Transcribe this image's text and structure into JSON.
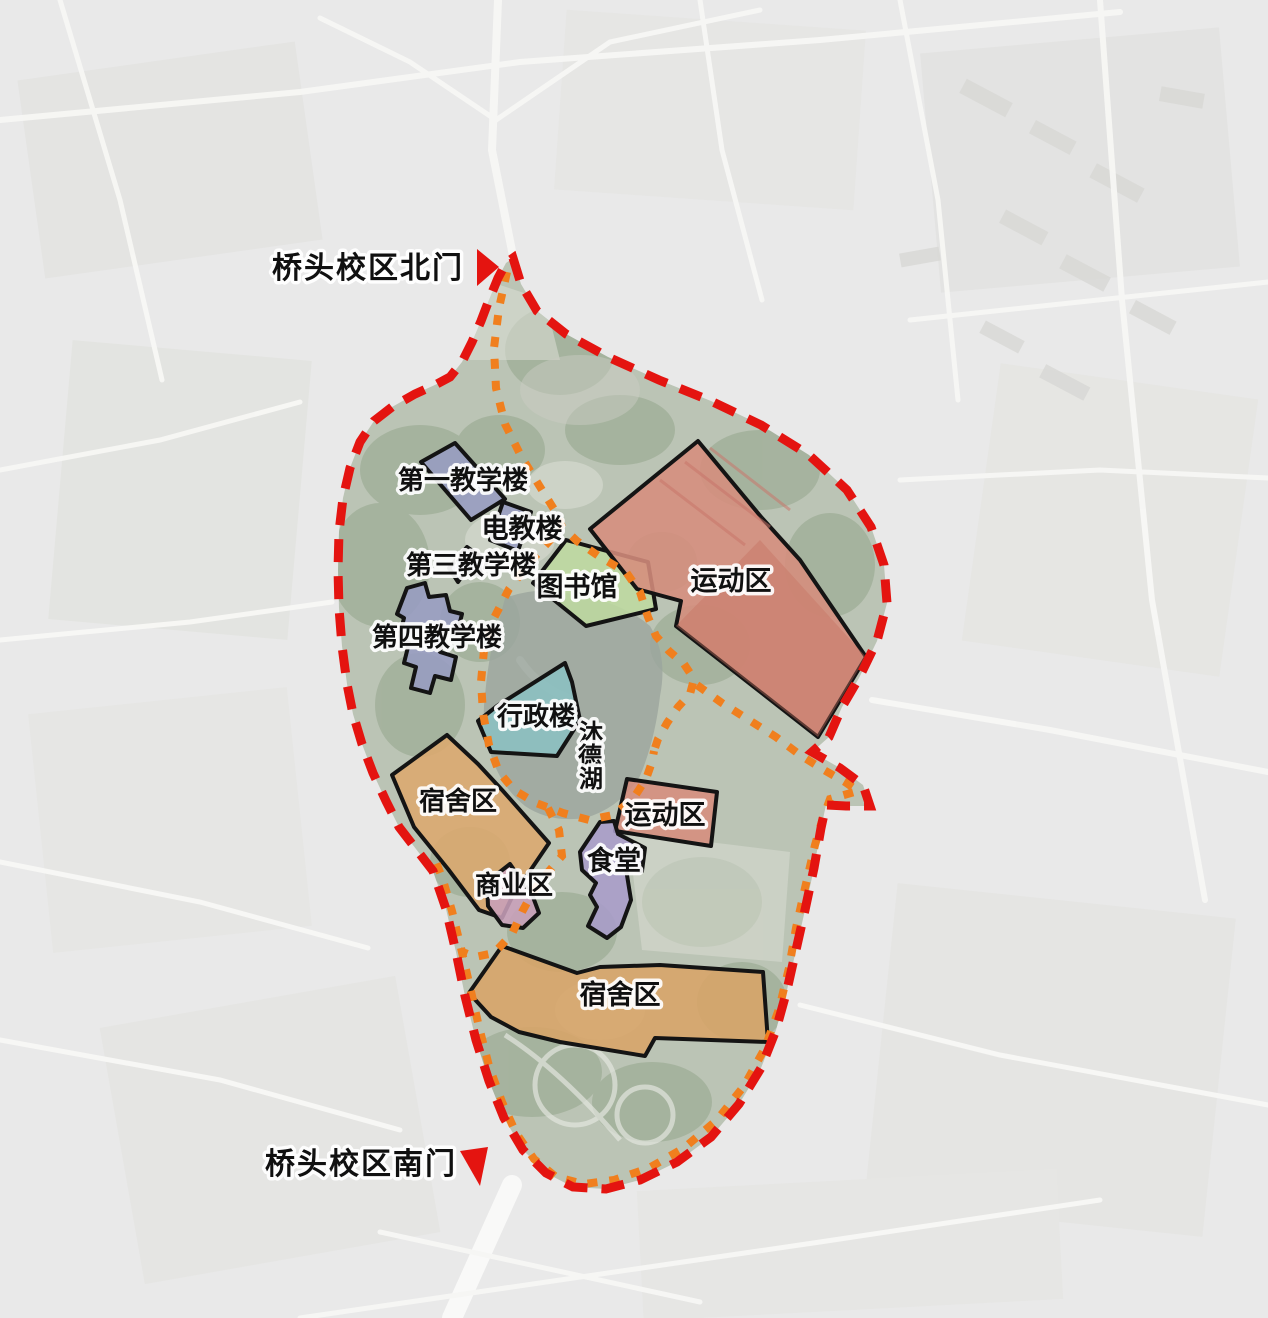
{
  "gates": {
    "north": {
      "label": "桥头校区北门"
    },
    "south": {
      "label": "桥头校区南门"
    }
  },
  "zones": [
    {
      "key": "teaching-building-1",
      "label": "第一教学楼",
      "color": "#979cc1"
    },
    {
      "key": "av-education-building",
      "label": "电教楼",
      "color": "#979cc1"
    },
    {
      "key": "teaching-building-3",
      "label": "第三教学楼",
      "color": "#979cc1"
    },
    {
      "key": "teaching-building-4",
      "label": "第四教学楼",
      "color": "#979cc1"
    },
    {
      "key": "library",
      "label": "图书馆",
      "color": "#bed9a0"
    },
    {
      "key": "sports-area-north",
      "label": "运动区",
      "color": "#d68d7d"
    },
    {
      "key": "admin-building",
      "label": "行政楼",
      "color": "#8cc2c3"
    },
    {
      "key": "dormitory-area-west",
      "label": "宿舍区",
      "color": "#dca96e"
    },
    {
      "key": "commercial-area",
      "label": "商业区",
      "color": "#c89fba"
    },
    {
      "key": "sports-area-central",
      "label": "运动区",
      "color": "#d68d7d"
    },
    {
      "key": "canteen",
      "label": "食堂",
      "color": "#a89cc9"
    },
    {
      "key": "dormitory-area-south",
      "label": "宿舍区",
      "color": "#d8a468"
    }
  ],
  "lake": {
    "name": "沐德湖",
    "chars": [
      "沐",
      "德",
      "湖"
    ]
  },
  "boundary": {
    "outer_color": "#e41410",
    "path_color": "#f07f1e"
  }
}
